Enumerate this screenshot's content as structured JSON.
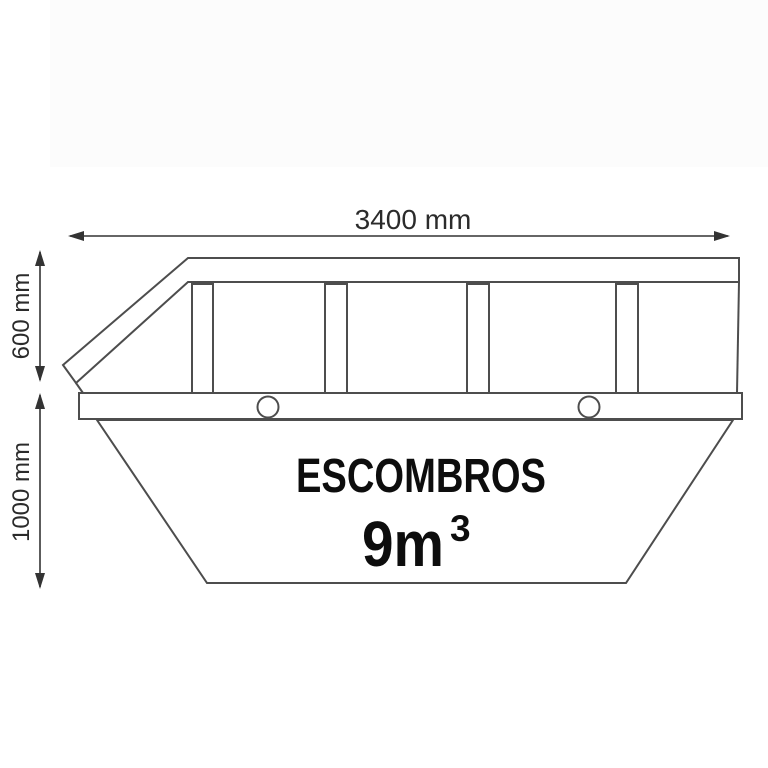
{
  "colors": {
    "background": "#ffffff",
    "background_tint": "#fcfcfc",
    "line": "#4d4d4d",
    "dimension": "#333333",
    "label_text": "#0d0d0d"
  },
  "diagram": {
    "kind": "skip-container-side-view",
    "dimensions": {
      "width_label": "3400 mm",
      "upper_height_label": "600 mm",
      "lower_height_label": "1000 mm"
    },
    "container": {
      "content_label": "ESCOMBROS",
      "volume_base": "9m",
      "volume_exponent": "3"
    }
  }
}
